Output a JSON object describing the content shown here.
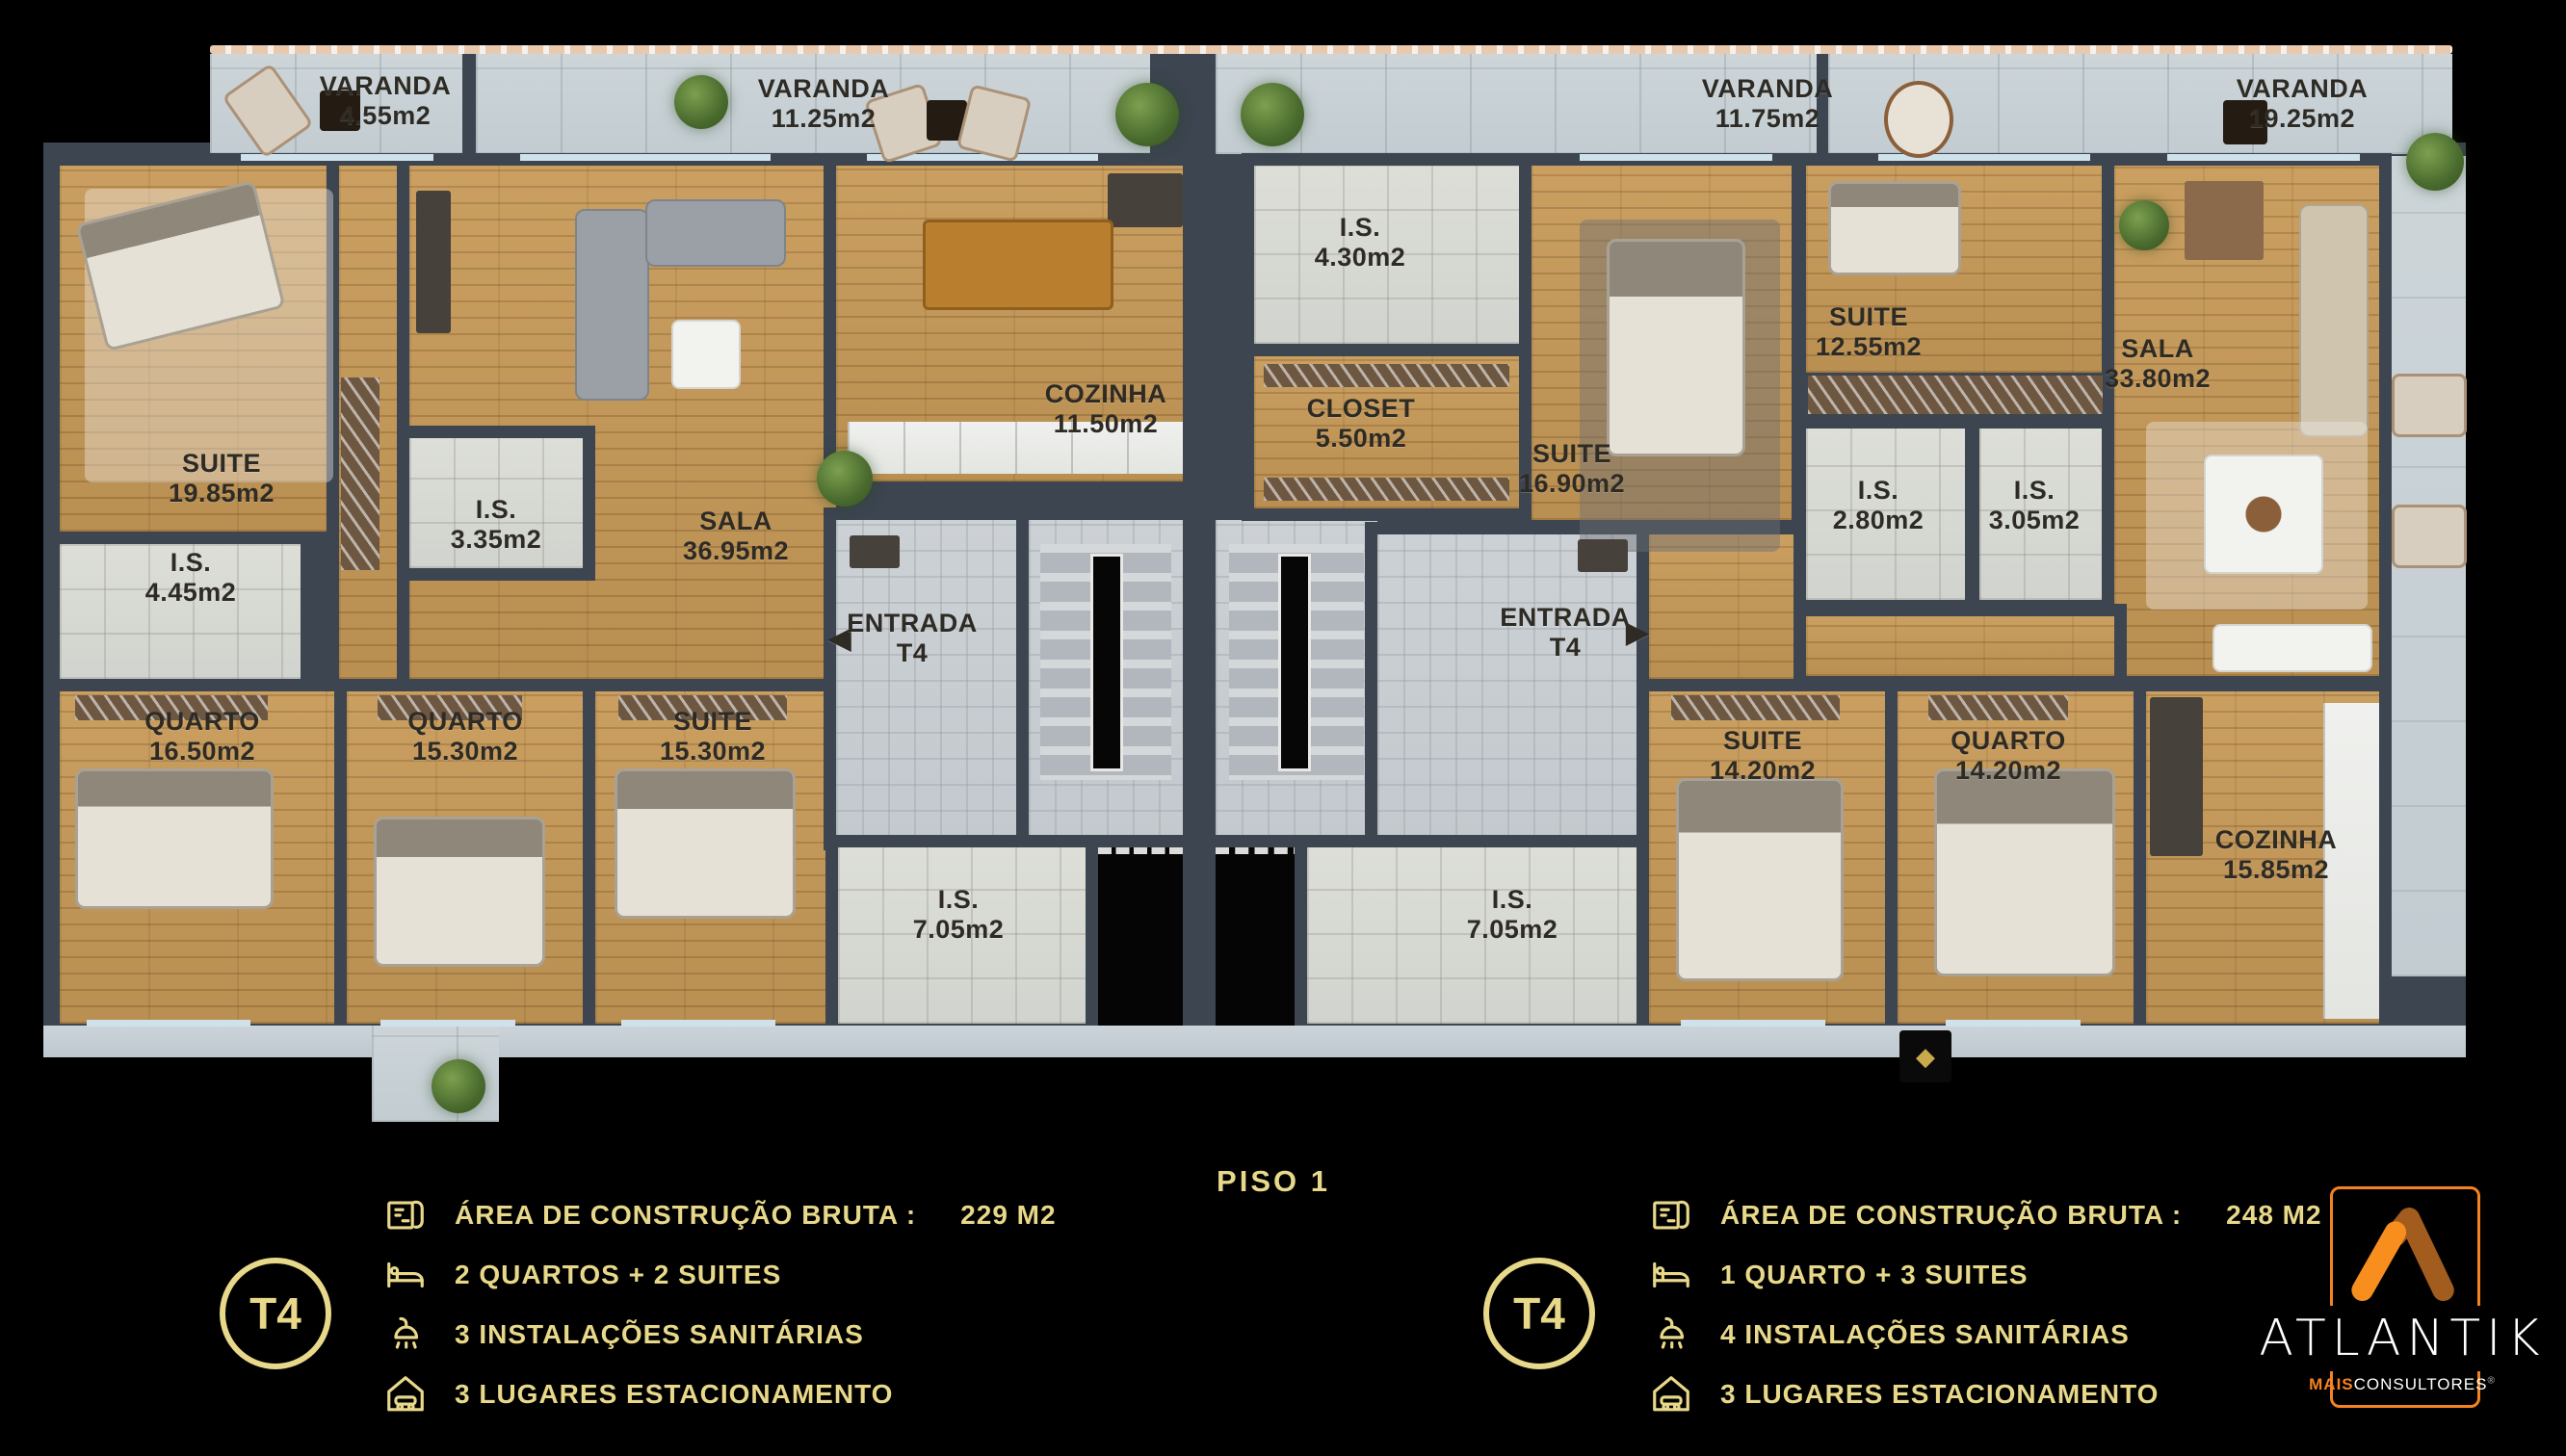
{
  "plan": {
    "floor_title": "PISO 1"
  },
  "rooms": {
    "varanda_1": {
      "name": "VARANDA",
      "area": "4.55m2"
    },
    "varanda_2": {
      "name": "VARANDA",
      "area": "11.25m2"
    },
    "varanda_3": {
      "name": "VARANDA",
      "area": "11.75m2"
    },
    "varanda_4": {
      "name": "VARANDA",
      "area": "19.25m2"
    },
    "suite_1985": {
      "name": "SUITE",
      "area": "19.85m2"
    },
    "is_445": {
      "name": "I.S.",
      "area": "4.45m2"
    },
    "is_335": {
      "name": "I.S.",
      "area": "3.35m2"
    },
    "sala_3695": {
      "name": "SALA",
      "area": "36.95m2"
    },
    "cozinha_1150": {
      "name": "COZINHA",
      "area": "11.50m2"
    },
    "entrada_left": {
      "name": "ENTRADA",
      "area": "T4"
    },
    "quarto_1650": {
      "name": "QUARTO",
      "area": "16.50m2"
    },
    "quarto_1530": {
      "name": "QUARTO",
      "area": "15.30m2"
    },
    "suite_1530": {
      "name": "SUITE",
      "area": "15.30m2"
    },
    "is_705_left": {
      "name": "I.S.",
      "area": "7.05m2"
    },
    "is_430": {
      "name": "I.S.",
      "area": "4.30m2"
    },
    "closet_550": {
      "name": "CLOSET",
      "area": "5.50m2"
    },
    "suite_1690": {
      "name": "SUITE",
      "area": "16.90m2"
    },
    "suite_1255": {
      "name": "SUITE",
      "area": "12.55m2"
    },
    "is_280": {
      "name": "I.S.",
      "area": "2.80m2"
    },
    "is_305": {
      "name": "I.S.",
      "area": "3.05m2"
    },
    "sala_3380": {
      "name": "SALA",
      "area": "33.80m2"
    },
    "entrada_right": {
      "name": "ENTRADA",
      "area": "T4"
    },
    "is_705_right": {
      "name": "I.S.",
      "area": "7.05m2"
    },
    "suite_1420": {
      "name": "SUITE",
      "area": "14.20m2"
    },
    "quarto_1420": {
      "name": "QUARTO",
      "area": "14.20m2"
    },
    "cozinha_1585": {
      "name": "COZINHA",
      "area": "15.85m2"
    }
  },
  "icons": {
    "entry_arrow_left": "◀",
    "entry_arrow_right": "▶",
    "marker_diamond": "◆"
  },
  "legend_left": {
    "badge": "T4",
    "rows": [
      {
        "icon": "floorplan-icon",
        "label": "ÁREA DE CONSTRUÇÃO BRUTA :",
        "value": "229 M2"
      },
      {
        "icon": "bed-icon",
        "label": "2 QUARTOS + 2 SUITES",
        "value": ""
      },
      {
        "icon": "shower-icon",
        "label": "3 INSTALAÇÕES SANITÁRIAS",
        "value": ""
      },
      {
        "icon": "garage-icon",
        "label": "3 LUGARES ESTACIONAMENTO",
        "value": ""
      }
    ]
  },
  "legend_right": {
    "badge": "T4",
    "rows": [
      {
        "icon": "floorplan-icon",
        "label": "ÁREA DE CONSTRUÇÃO BRUTA :",
        "value": "248 M2"
      },
      {
        "icon": "bed-icon",
        "label": "1 QUARTO + 3 SUITES",
        "value": ""
      },
      {
        "icon": "shower-icon",
        "label": "4 INSTALAÇÕES SANITÁRIAS",
        "value": ""
      },
      {
        "icon": "garage-icon",
        "label": "3 LUGARES ESTACIONAMENTO",
        "value": ""
      }
    ]
  },
  "logo": {
    "name": "ATLANTIK",
    "sub_bold": "MAIS",
    "sub_rest": "CONSULTORES",
    "reg": "®"
  },
  "colors": {
    "background": "#000000",
    "legend_gold": "#E8D88A",
    "logo_orange": "#F58220",
    "logo_orange_dark": "#A15C1E",
    "wall": "#3C4550",
    "wood_floor": "#C79A58"
  }
}
